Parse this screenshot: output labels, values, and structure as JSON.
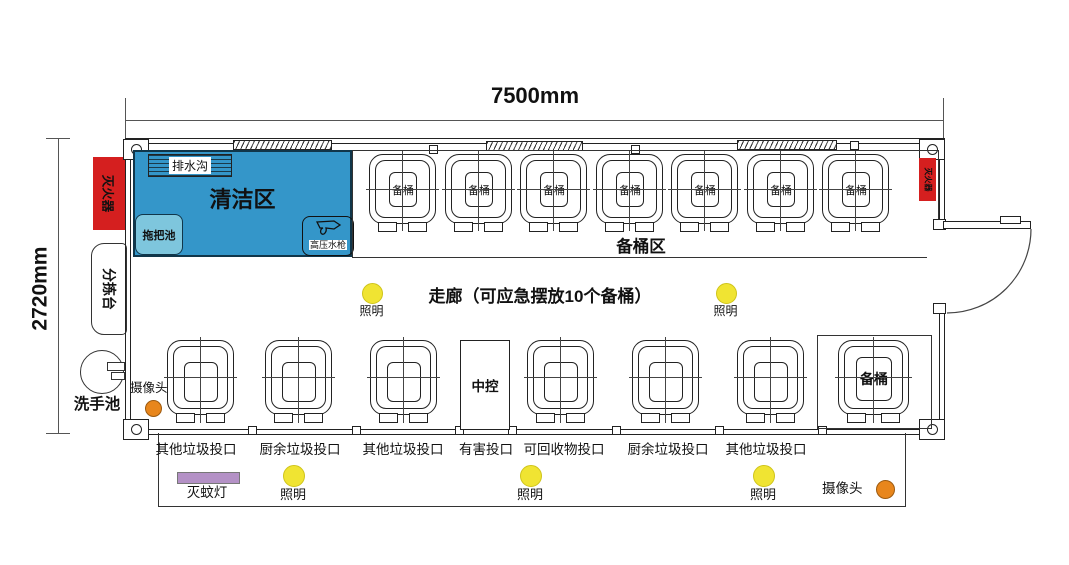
{
  "dimension_labels": {
    "width": "7500mm",
    "height": "2720mm"
  },
  "zones": {
    "cleaning": {
      "label": "清洁区",
      "fill": "#3496C9",
      "border": "#10364A"
    },
    "drain": {
      "label": "排水沟"
    },
    "mop_sink": {
      "label": "拖把池",
      "fill": "#7EC6DD"
    },
    "pressure_gun": {
      "label": "高压水枪"
    },
    "spare_zone": {
      "label": "备桶区"
    },
    "corridor": {
      "label": "走廊（可应急摆放10个备桶）"
    },
    "central_control": {
      "label": "中控"
    }
  },
  "top_row": {
    "bucket_labels": [
      "备桶",
      "备桶",
      "备桶",
      "备桶",
      "备桶",
      "备桶",
      "备桶"
    ]
  },
  "right_spare": {
    "label": "备桶"
  },
  "chute_labels": [
    "其他垃圾投口",
    "厨余垃圾投口",
    "其他垃圾投口",
    "有害投口",
    "可回收物投口",
    "厨余垃圾投口",
    "其他垃圾投口"
  ],
  "lights": {
    "corridor": [
      "照明",
      "照明"
    ],
    "porch": [
      "照明",
      "照明",
      "照明"
    ],
    "color": "#F0E432"
  },
  "cameras": {
    "interior_label": "摄像头",
    "exterior_label": "摄像头",
    "color": "#E8861C"
  },
  "fire_extinguishers": {
    "left": "灭火器",
    "right": "灭火器",
    "color": "#D51F1F"
  },
  "sorting_table": {
    "label": "分拣台"
  },
  "hand_sink": {
    "label": "洗手池"
  },
  "mosquito_lamp": {
    "label": "灭蚊灯",
    "color": "#B491C6"
  }
}
